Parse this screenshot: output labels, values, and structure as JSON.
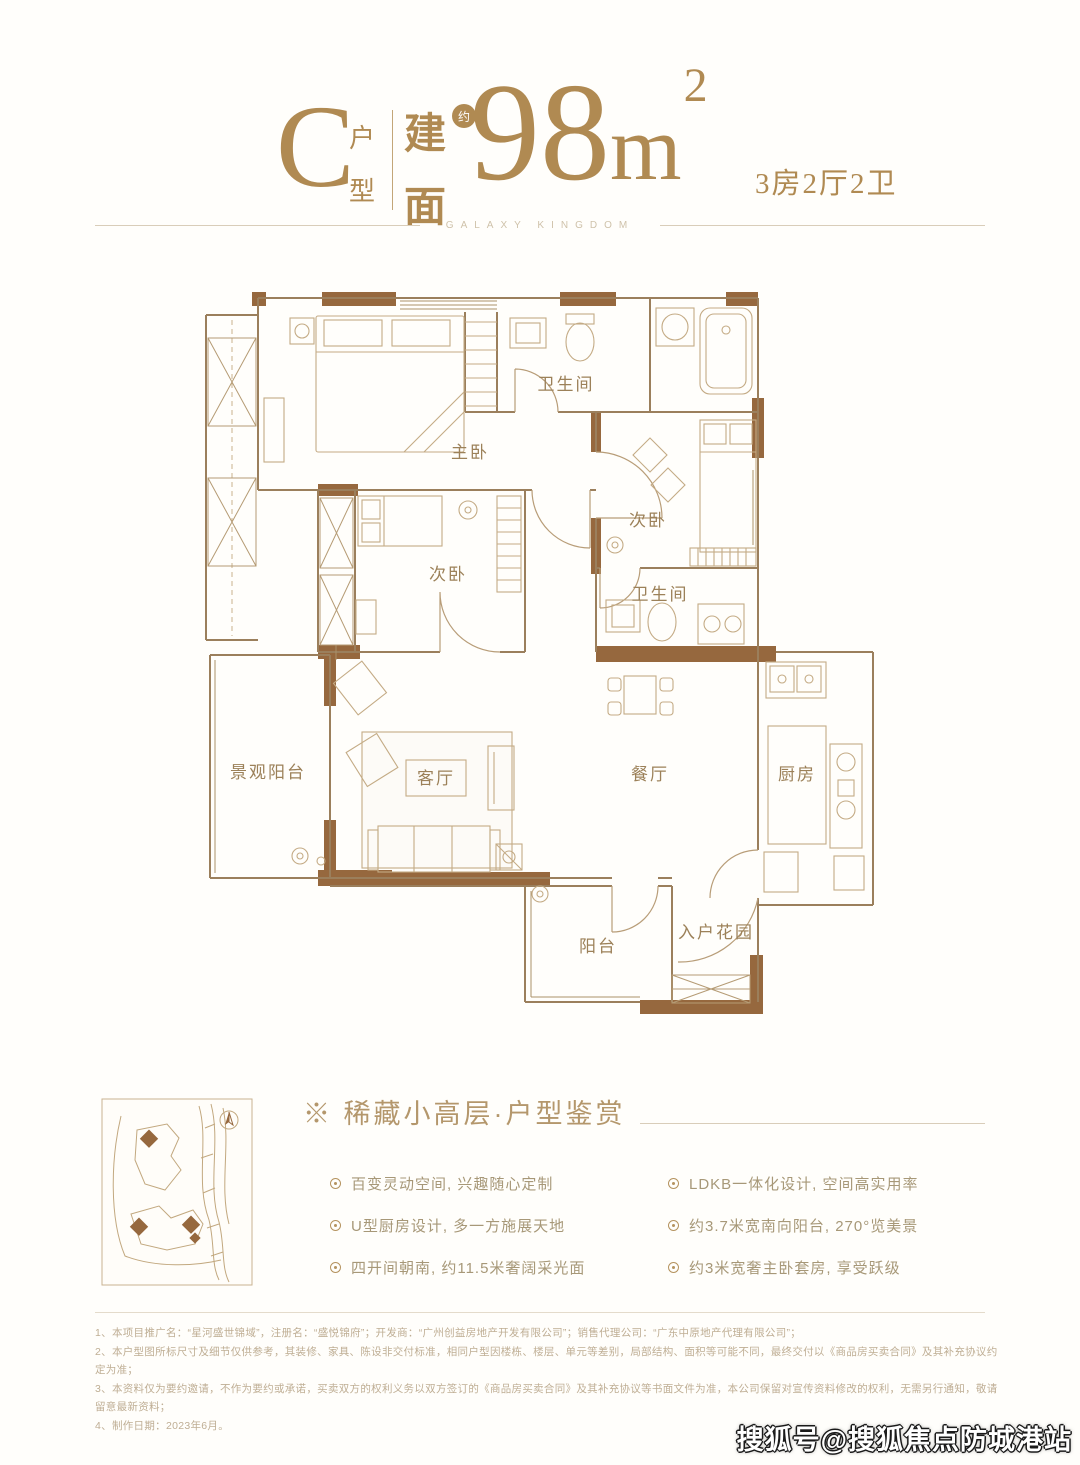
{
  "header": {
    "type_letter": "C",
    "type_chars": [
      "户",
      "型"
    ],
    "area_chars": [
      "建",
      "面"
    ],
    "approx_badge": "约",
    "area_value": "98",
    "area_unit": "m",
    "area_sup": "2",
    "spec": "3房2厅2卫",
    "brand_line": "GALAXY KINGDOM"
  },
  "floor_plan": {
    "rooms": {
      "master_bedroom": "主卧",
      "bathroom_top": "卫生间",
      "bedroom_right": "次卧",
      "bathroom_right": "卫生间",
      "bedroom_left": "次卧",
      "view_balcony": "景观阳台",
      "living_room": "客厅",
      "dining_room": "餐厅",
      "kitchen": "厨房",
      "balcony": "阳台",
      "entry_garden": "入户花园"
    }
  },
  "features": {
    "heading": "※ 稀藏小高层·户型鉴赏",
    "left": [
      "百变灵动空间, 兴趣随心定制",
      "U型厨房设计, 多一方施展天地",
      "四开间朝南, 约11.5米奢阔采光面"
    ],
    "right": [
      "LDKB一体化设计, 空间高实用率",
      "约3.7米宽南向阳台, 270°览美景",
      "约3米宽奢主卧套房, 享受跃级"
    ]
  },
  "disclaimer": [
    "1、本项目推广名：“星河盛世锦域”，注册名：“盛悦锦府”；开发商：“广州创益房地产开发有限公司”；销售代理公司：“广东中原地产代理有限公司”；",
    "2、本户型图所标尺寸及细节仅供参考，其装修、家具、陈设非交付标准，相同户型因楼栋、楼层、单元等差别，局部结构、面积等可能不同，最终交付以《商品房买卖合同》及其补充协议约定为准；",
    "3、本资料仅为要约邀请，不作为要约或承诺，买卖双方的权利义务以双方签订的《商品房买卖合同》及其补充协议等书面文件为准，本公司保留对宣传资料修改的权利，无需另行通知，敬请留意最新资料；",
    "4、制作日期：2023年6月。"
  ],
  "watermark": "搜狐号@搜狐焦点防城港站",
  "colors": {
    "gold": "#b08a52",
    "wall_brown": "#96683e"
  }
}
